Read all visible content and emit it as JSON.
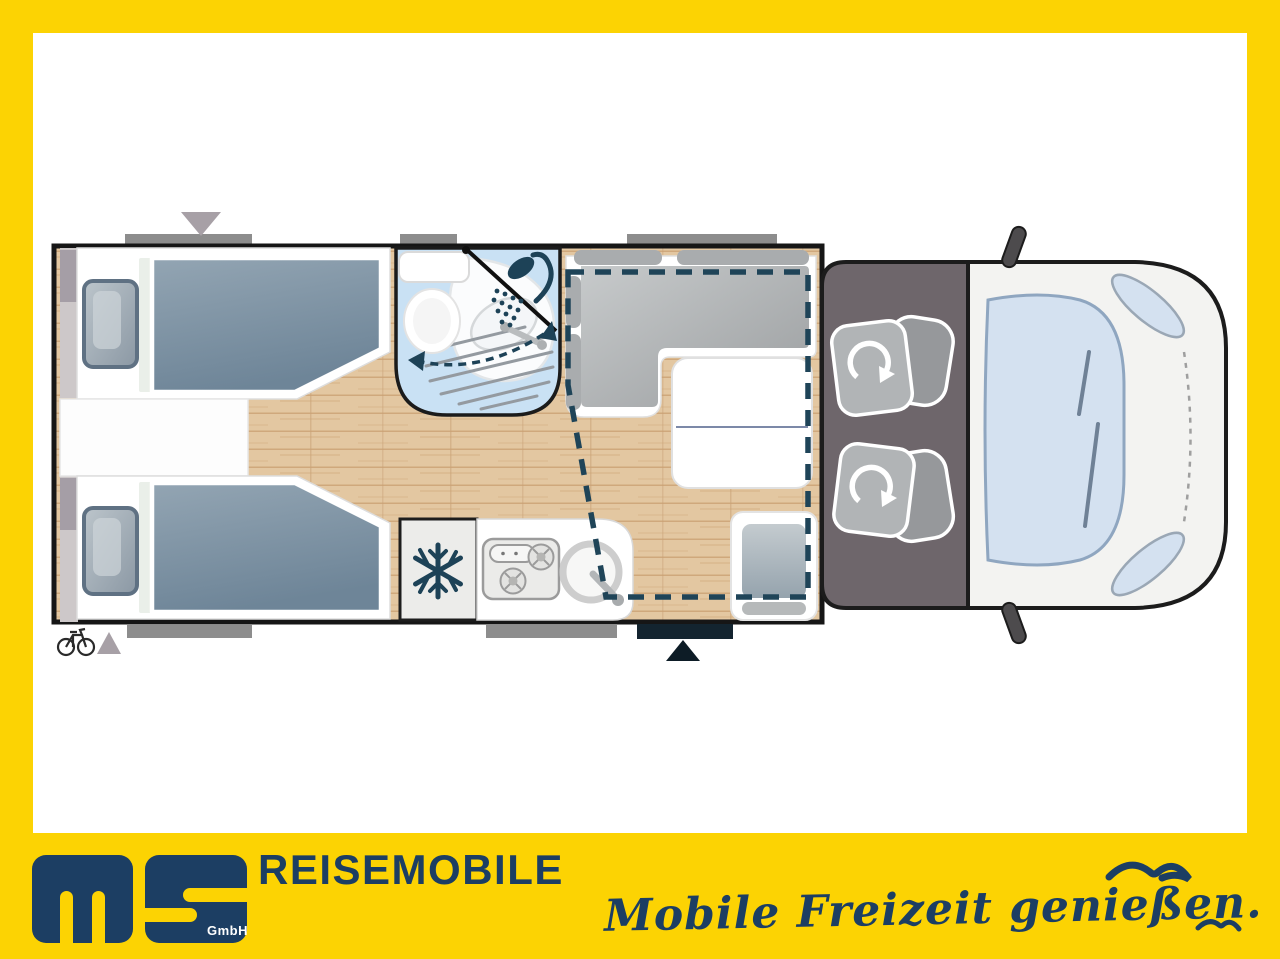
{
  "branding": {
    "logo_monogram": "ms",
    "logo_company_suffix": "GmbH",
    "wordmark": "REISEMOBILE",
    "tagline": "Mobile Freizeit genießen."
  },
  "colors": {
    "frame_yellow": "#FCD303",
    "brand_navy": "#1C3E63",
    "floor_wood": "#E3C7A1",
    "bathroom_blue": "#C9E1F4",
    "cab_gray": "#6E666B",
    "cushion_gray": "#A9ACAE",
    "blanket_gray_blue": "#7E93A4",
    "dashed_bed_outline": "#1F4458",
    "window_bar_gray": "#8D8D8D",
    "entry_door_navy": "#13242F"
  },
  "floorplan": {
    "view": "motorhome-top-view",
    "areas": [
      "twin-single-beds-rear",
      "wardrobe-strip",
      "bathroom-with-swivel-wall-shower-and-toilet",
      "l-shaped-dinette-with-table",
      "drop-down-bed-dashed-outline",
      "kitchen-with-fridge-cooktop-and-sink",
      "entry-door",
      "side-seat",
      "cab-with-two-swivel-seats"
    ]
  },
  "icons": [
    "snowflake-icon",
    "shower-head-icon",
    "bicycle-icon",
    "rotation-arrow-icon",
    "entry-arrow-icon",
    "rear-marker-triangle-icon",
    "seagull-icon"
  ]
}
